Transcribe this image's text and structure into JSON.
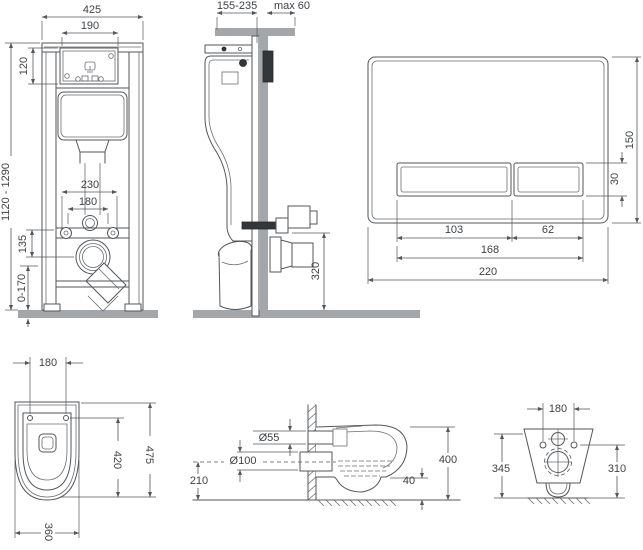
{
  "drawing": {
    "frame_front": {
      "width": "425",
      "service_opening_width": "190",
      "service_opening_height": "120",
      "height_range": "1120 - 1290",
      "fixing_hole_spacing": "230",
      "inner_hole_spacing": "180",
      "rail_to_outlet": "135",
      "floor_adjust_range": "0-170"
    },
    "frame_side": {
      "depth_range": "155-235",
      "top_clearance": "max 60",
      "outlet_height": "320"
    },
    "flush_plate": {
      "plate_height": "150",
      "button_height": "30",
      "large_button_width": "103",
      "small_button_width": "62",
      "buttons_total_width": "168",
      "plate_width": "220"
    },
    "pan_top": {
      "fixing_hole_spacing": "180",
      "inner_length": "420",
      "total_length": "475",
      "width": "360"
    },
    "pan_side": {
      "inlet_diameter": "Ø55",
      "outlet_diameter": "Ø100",
      "outlet_axis_height": "210",
      "total_depth": "400",
      "bottom_clearance": "40"
    },
    "pan_rear": {
      "fixing_hole_spacing": "180",
      "overall_height": "345",
      "side_height": "310"
    }
  },
  "colors": {
    "line": "#53565a",
    "text": "#3f4245",
    "surface_gray": "#a3a7aa",
    "dark_unit": "#33373a",
    "background": "#ffffff"
  }
}
